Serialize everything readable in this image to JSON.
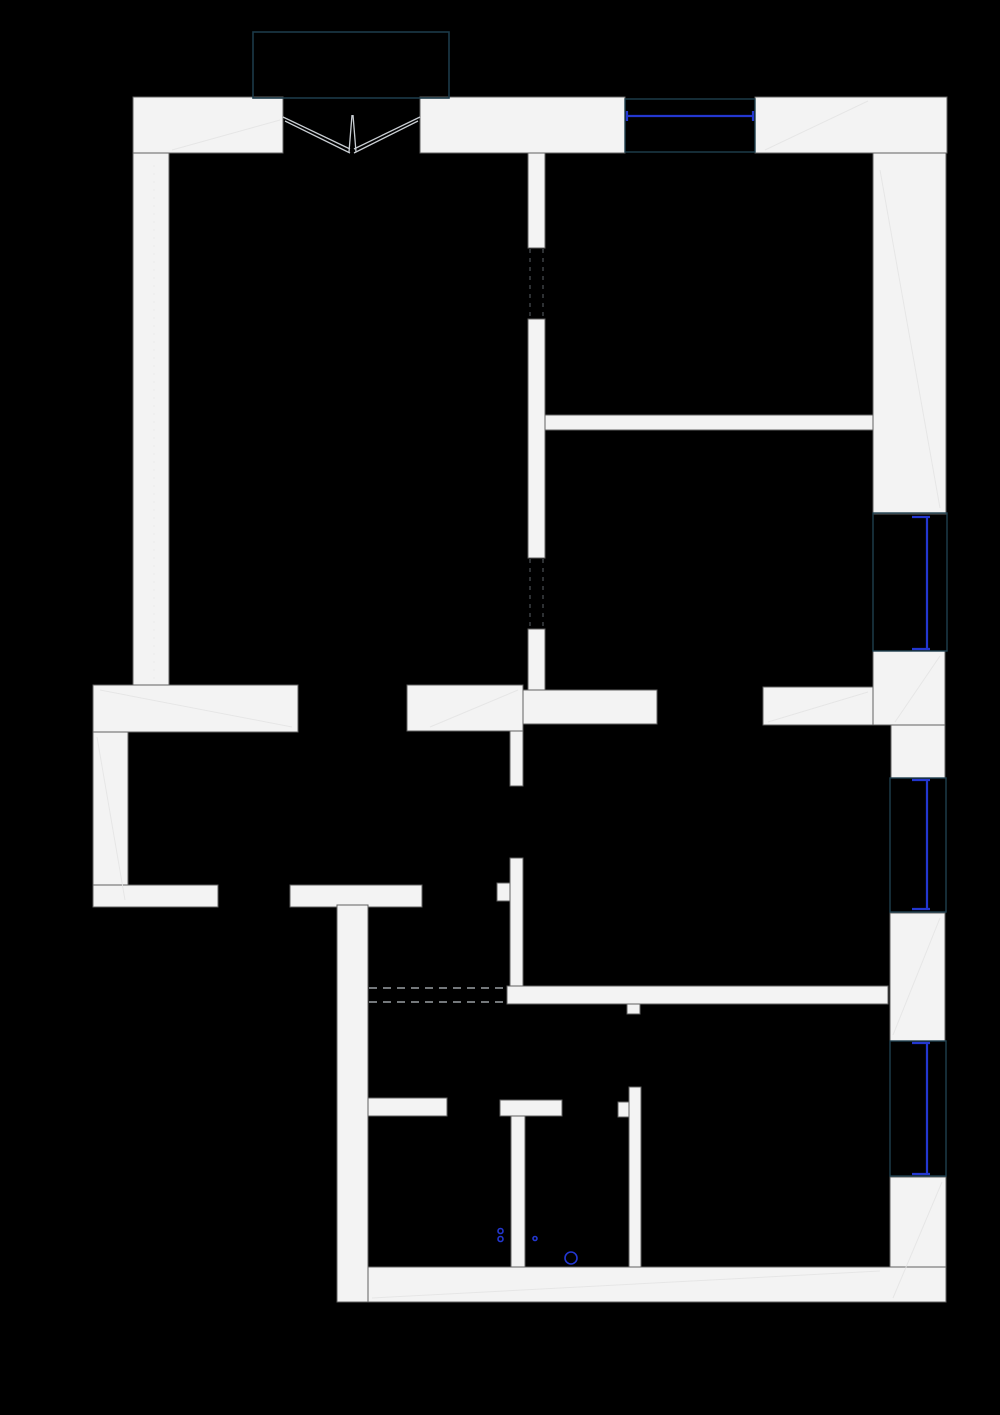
{
  "canvas": {
    "width": 1000,
    "height": 1415,
    "background": "#000000"
  },
  "colors": {
    "wall_fill": "#f3f3f3",
    "wall_stroke": "#616161",
    "glazing_blue": "#2337d0",
    "frame_teal": "#1e3f4e",
    "porch_teal": "#1b3a49",
    "swing_gray": "#c9ced3",
    "opening_dash_gray": "#9aa0a4",
    "door_dash_gray": "#3c4144",
    "seam_gray": "#e4e4e4",
    "fixture_blue": "#2337d0"
  },
  "plan": {
    "walls": [
      {
        "name": "top-wall-left",
        "x": 133,
        "y": 97,
        "w": 150,
        "h": 56
      },
      {
        "name": "top-wall-mid",
        "x": 420,
        "y": 97,
        "w": 205,
        "h": 56
      },
      {
        "name": "top-wall-right",
        "x": 755,
        "y": 97,
        "w": 192,
        "h": 56
      },
      {
        "name": "left-wall-upper",
        "x": 133,
        "y": 153,
        "w": 36,
        "h": 532
      },
      {
        "name": "right-wall-upper",
        "x": 873,
        "y": 153,
        "w": 73,
        "h": 361
      },
      {
        "name": "partition-vert-a",
        "x": 528,
        "y": 153,
        "w": 17,
        "h": 95
      },
      {
        "name": "partition-vert-b",
        "x": 528,
        "y": 319,
        "w": 17,
        "h": 239
      },
      {
        "name": "partition-vert-c",
        "x": 528,
        "y": 629,
        "w": 17,
        "h": 61
      },
      {
        "name": "room-divider-right",
        "x": 545,
        "y": 415,
        "w": 328,
        "h": 15
      },
      {
        "name": "right-junction-upper",
        "x": 873,
        "y": 651,
        "w": 72,
        "h": 74
      },
      {
        "name": "right-junction-lower",
        "x": 891,
        "y": 725,
        "w": 54,
        "h": 53
      },
      {
        "name": "step-band-left",
        "x": 93,
        "y": 685,
        "w": 205,
        "h": 47
      },
      {
        "name": "left-wall-lower",
        "x": 93,
        "y": 732,
        "w": 35,
        "h": 175
      },
      {
        "name": "bottom-left-band-a",
        "x": 93,
        "y": 885,
        "w": 125,
        "h": 22
      },
      {
        "name": "bottom-left-band-b",
        "x": 290,
        "y": 885,
        "w": 132,
        "h": 22
      },
      {
        "name": "hall-band-a",
        "x": 407,
        "y": 685,
        "w": 116,
        "h": 46
      },
      {
        "name": "hall-band-b",
        "x": 523,
        "y": 690,
        "w": 134,
        "h": 34
      },
      {
        "name": "hall-band-c",
        "x": 763,
        "y": 687,
        "w": 110,
        "h": 38
      },
      {
        "name": "hall-vert-upper",
        "x": 510,
        "y": 731,
        "w": 13,
        "h": 55
      },
      {
        "name": "hall-vert-lower",
        "x": 510,
        "y": 858,
        "w": 13,
        "h": 146
      },
      {
        "name": "hall-stub",
        "x": 497,
        "y": 883,
        "w": 13,
        "h": 18
      },
      {
        "name": "lower-cross-band",
        "x": 507,
        "y": 986,
        "w": 381,
        "h": 18
      },
      {
        "name": "lower-cross-stub",
        "x": 627,
        "y": 1004,
        "w": 13,
        "h": 10
      },
      {
        "name": "bottom-left-wall",
        "x": 337,
        "y": 905,
        "w": 31,
        "h": 397
      },
      {
        "name": "wc-stub-left",
        "x": 368,
        "y": 1098,
        "w": 79,
        "h": 18
      },
      {
        "name": "wc-stub-right",
        "x": 500,
        "y": 1100,
        "w": 62,
        "h": 16
      },
      {
        "name": "wc-wall-a",
        "x": 511,
        "y": 1116,
        "w": 14,
        "h": 151
      },
      {
        "name": "wc-wall-b",
        "x": 629,
        "y": 1087,
        "w": 12,
        "h": 180
      },
      {
        "name": "wc-flag",
        "x": 618,
        "y": 1102,
        "w": 11,
        "h": 15
      },
      {
        "name": "right-pier-mid",
        "x": 890,
        "y": 913,
        "w": 55,
        "h": 128
      },
      {
        "name": "right-wall-lower",
        "x": 890,
        "y": 1177,
        "w": 56,
        "h": 125
      },
      {
        "name": "bottom-band",
        "x": 368,
        "y": 1267,
        "w": 578,
        "h": 35
      }
    ],
    "window_frames": [
      {
        "name": "window-frame-top",
        "x": 625,
        "y": 99,
        "w": 130,
        "h": 53
      },
      {
        "name": "window-frame-right-1",
        "x": 873,
        "y": 513,
        "w": 74,
        "h": 138
      },
      {
        "name": "window-frame-right-2",
        "x": 890,
        "y": 778,
        "w": 56,
        "h": 134
      },
      {
        "name": "window-frame-right-3",
        "x": 890,
        "y": 1041,
        "w": 56,
        "h": 135
      }
    ],
    "glazing": [
      {
        "name": "glazing-top",
        "x1": 627,
        "y1": 116,
        "x2": 753,
        "y2": 116
      },
      {
        "name": "glazing-right-1",
        "x1": 927,
        "y1": 517,
        "x2": 927,
        "y2": 649
      },
      {
        "name": "glazing-right-2",
        "x1": 927,
        "y1": 780,
        "x2": 927,
        "y2": 909
      },
      {
        "name": "glazing-right-3",
        "x1": 927,
        "y1": 1043,
        "x2": 927,
        "y2": 1174
      }
    ],
    "glazing_ticks": [
      {
        "x1": 627,
        "y1": 111,
        "x2": 627,
        "y2": 121
      },
      {
        "x1": 753,
        "y1": 111,
        "x2": 753,
        "y2": 121
      },
      {
        "x1": 912,
        "y1": 517,
        "x2": 930,
        "y2": 517
      },
      {
        "x1": 912,
        "y1": 649,
        "x2": 930,
        "y2": 649
      },
      {
        "x1": 912,
        "y1": 780,
        "x2": 930,
        "y2": 780
      },
      {
        "x1": 912,
        "y1": 909,
        "x2": 930,
        "y2": 909
      },
      {
        "x1": 912,
        "y1": 1043,
        "x2": 930,
        "y2": 1043
      },
      {
        "x1": 912,
        "y1": 1174,
        "x2": 930,
        "y2": 1174
      }
    ],
    "porch": {
      "x": 253,
      "y": 32,
      "w": 196,
      "h": 66
    },
    "entry_swing": [
      {
        "x1": 283,
        "y1": 117,
        "x2": 350,
        "y2": 149
      },
      {
        "x1": 285,
        "y1": 121,
        "x2": 350,
        "y2": 153
      },
      {
        "x1": 420,
        "y1": 117,
        "x2": 354,
        "y2": 149
      },
      {
        "x1": 418,
        "y1": 121,
        "x2": 354,
        "y2": 153
      },
      {
        "x1": 352,
        "y1": 115,
        "x2": 349,
        "y2": 152
      },
      {
        "x1": 353,
        "y1": 115,
        "x2": 356,
        "y2": 152
      }
    ],
    "opening_dashes": [
      {
        "x1": 369,
        "y1": 988,
        "x2": 506,
        "y2": 988
      },
      {
        "x1": 369,
        "y1": 1002,
        "x2": 506,
        "y2": 1002
      }
    ],
    "door_dashes": [
      {
        "x1": 530,
        "y1": 249,
        "x2": 530,
        "y2": 318
      },
      {
        "x1": 543,
        "y1": 249,
        "x2": 543,
        "y2": 318
      },
      {
        "x1": 530,
        "y1": 559,
        "x2": 530,
        "y2": 628
      },
      {
        "x1": 543,
        "y1": 559,
        "x2": 543,
        "y2": 628
      }
    ],
    "seams": [
      {
        "x1": 172,
        "y1": 150,
        "x2": 280,
        "y2": 120
      },
      {
        "x1": 765,
        "y1": 150,
        "x2": 868,
        "y2": 101
      },
      {
        "x1": 880,
        "y1": 170,
        "x2": 940,
        "y2": 508
      },
      {
        "x1": 100,
        "y1": 690,
        "x2": 292,
        "y2": 727
      },
      {
        "x1": 97,
        "y1": 737,
        "x2": 125,
        "y2": 900
      },
      {
        "x1": 895,
        "y1": 722,
        "x2": 940,
        "y2": 656
      },
      {
        "x1": 893,
        "y1": 1035,
        "x2": 940,
        "y2": 918
      },
      {
        "x1": 768,
        "y1": 722,
        "x2": 868,
        "y2": 692
      },
      {
        "x1": 372,
        "y1": 1298,
        "x2": 880,
        "y2": 1271
      },
      {
        "x1": 893,
        "y1": 1298,
        "x2": 942,
        "y2": 1182
      },
      {
        "x1": 430,
        "y1": 727,
        "x2": 518,
        "y2": 690
      }
    ],
    "seam_dashed": [
      {
        "x1": 154,
        "y1": 165,
        "x2": 154,
        "y2": 680
      }
    ],
    "fixtures": [
      {
        "name": "fixture-circle-large",
        "cx": 571,
        "cy": 1258,
        "r": 6
      },
      {
        "name": "fixture-dot-a",
        "cx": 500.5,
        "cy": 1231,
        "r": 2.5
      },
      {
        "name": "fixture-dot-b",
        "cx": 500.5,
        "cy": 1239,
        "r": 2.5
      },
      {
        "name": "fixture-dot-c",
        "cx": 535,
        "cy": 1238.5,
        "r": 2
      }
    ]
  }
}
